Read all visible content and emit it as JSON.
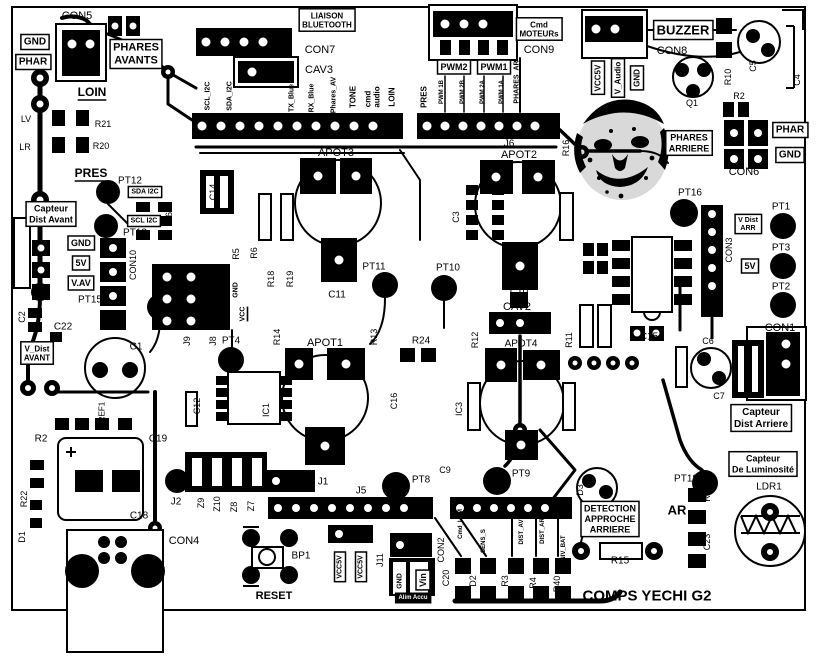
{
  "board": {
    "title": "COMPS YECHI G2",
    "colors": {
      "silkscreen": "#000000",
      "background": "#ffffff"
    }
  },
  "labels": [
    {
      "t": "CON5",
      "x": 77,
      "y": 16,
      "s": 11
    },
    {
      "t": "GND",
      "x": 35,
      "y": 42,
      "s": 10,
      "b": 1,
      "box": 1
    },
    {
      "t": "PHAR",
      "x": 33,
      "y": 62,
      "s": 10,
      "b": 1,
      "box": 1
    },
    {
      "t": "PHARES\nAVANTS",
      "x": 136,
      "y": 54,
      "s": 11,
      "b": 1,
      "box": 1,
      "n": "phares-avants-label"
    },
    {
      "t": "LOIN",
      "x": 92,
      "y": 92,
      "s": 12,
      "b": 1,
      "u": 1
    },
    {
      "t": "LV",
      "x": 26,
      "y": 119,
      "s": 9
    },
    {
      "t": "R21",
      "x": 103,
      "y": 124,
      "s": 9
    },
    {
      "t": "LR",
      "x": 25,
      "y": 147,
      "s": 9
    },
    {
      "t": "R20",
      "x": 101,
      "y": 146,
      "s": 9
    },
    {
      "t": "PRES",
      "x": 91,
      "y": 173,
      "s": 12,
      "b": 1,
      "u": 1
    },
    {
      "t": "LIAISON\nBLUETOOTH",
      "x": 327,
      "y": 20,
      "s": 8,
      "b": 1,
      "box": 1,
      "n": "liaison-bluetooth-label"
    },
    {
      "t": "CON7",
      "x": 320,
      "y": 50,
      "s": 11
    },
    {
      "t": "CAV3",
      "x": 319,
      "y": 70,
      "s": 11
    },
    {
      "t": "SCL_I2C",
      "x": 208,
      "y": 96,
      "s": 7,
      "b": 1,
      "r": -90
    },
    {
      "t": "SDA_I2C",
      "x": 230,
      "y": 96,
      "s": 7,
      "b": 1,
      "r": -90
    },
    {
      "t": "TX_Blue",
      "x": 292,
      "y": 98,
      "s": 7,
      "b": 1,
      "r": -90
    },
    {
      "t": "RX_Blue",
      "x": 312,
      "y": 98,
      "s": 7,
      "b": 1,
      "r": -90
    },
    {
      "t": "Phares_AV",
      "x": 334,
      "y": 95,
      "s": 7,
      "b": 1,
      "r": -90
    },
    {
      "t": "TONE",
      "x": 353,
      "y": 97,
      "s": 8,
      "b": 1,
      "r": -90
    },
    {
      "t": "cmd",
      "x": 368,
      "y": 99,
      "s": 8,
      "b": 1,
      "r": -90
    },
    {
      "t": "audio",
      "x": 377,
      "y": 97,
      "s": 8,
      "b": 1,
      "r": -90
    },
    {
      "t": "LOIN",
      "x": 392,
      "y": 97,
      "s": 8,
      "b": 1,
      "r": -90
    },
    {
      "t": "PRES",
      "x": 424,
      "y": 97,
      "s": 8,
      "b": 1,
      "r": -90
    },
    {
      "t": "PWM 1B",
      "x": 442,
      "y": 92,
      "s": 6,
      "b": 1,
      "r": -90
    },
    {
      "t": "PWM 2B",
      "x": 463,
      "y": 92,
      "s": 6,
      "b": 1,
      "r": -90
    },
    {
      "t": "PWM 2A",
      "x": 483,
      "y": 92,
      "s": 6,
      "b": 1,
      "r": -90
    },
    {
      "t": "PWM 1A",
      "x": 502,
      "y": 92,
      "s": 6,
      "b": 1,
      "r": -90
    },
    {
      "t": "PHARES_AR",
      "x": 517,
      "y": 82,
      "s": 7,
      "b": 1,
      "r": -90
    },
    {
      "t": "PWM2",
      "x": 454,
      "y": 67,
      "s": 9,
      "b": 1,
      "box": 1
    },
    {
      "t": "PWM1",
      "x": 494,
      "y": 67,
      "s": 9,
      "b": 1,
      "box": 1
    },
    {
      "t": "Cmd\nMOTEURs",
      "x": 539,
      "y": 29,
      "s": 8,
      "b": 1,
      "box": 1,
      "n": "cmd-moteurs-label"
    },
    {
      "t": "CON9",
      "x": 539,
      "y": 50,
      "s": 11
    },
    {
      "t": "BUZZER",
      "x": 683,
      "y": 30,
      "s": 13,
      "b": 1,
      "box": 1,
      "n": "buzzer-label"
    },
    {
      "t": "CON8",
      "x": 672,
      "y": 51,
      "s": 11
    },
    {
      "t": "VCC5V",
      "x": 598,
      "y": 78,
      "s": 8,
      "b": 1,
      "r": -90,
      "box": 1
    },
    {
      "t": "V_Audio",
      "x": 618,
      "y": 78,
      "s": 8,
      "b": 1,
      "r": -90,
      "box": 1
    },
    {
      "t": "GND",
      "x": 637,
      "y": 78,
      "s": 8,
      "b": 1,
      "r": -90,
      "box": 1
    },
    {
      "t": "Q1",
      "x": 692,
      "y": 103,
      "s": 9
    },
    {
      "t": "C5",
      "x": 753,
      "y": 66,
      "s": 9,
      "r": -90
    },
    {
      "t": "C4",
      "x": 797,
      "y": 80,
      "s": 9,
      "r": -90
    },
    {
      "t": "R10",
      "x": 728,
      "y": 77,
      "s": 9,
      "r": -90
    },
    {
      "t": "R2",
      "x": 739,
      "y": 96,
      "s": 9
    },
    {
      "t": "PHAR",
      "x": 790,
      "y": 130,
      "s": 10,
      "b": 1,
      "box": 1
    },
    {
      "t": "GND",
      "x": 790,
      "y": 155,
      "s": 10,
      "b": 1,
      "box": 1
    },
    {
      "t": "PHARES\nARRIERE",
      "x": 689,
      "y": 143,
      "s": 9,
      "b": 1,
      "box": 1,
      "n": "phares-arriere-label"
    },
    {
      "t": "CON6",
      "x": 744,
      "y": 172,
      "s": 11
    },
    {
      "t": "R16",
      "x": 566,
      "y": 148,
      "s": 9,
      "r": -90
    },
    {
      "t": "J6",
      "x": 509,
      "y": 144,
      "s": 10
    },
    {
      "t": "APOT2",
      "x": 519,
      "y": 155,
      "s": 11
    },
    {
      "t": "APOT3",
      "x": 336,
      "y": 153,
      "s": 11
    },
    {
      "t": "PT16",
      "x": 690,
      "y": 193,
      "s": 10
    },
    {
      "t": "PT1",
      "x": 781,
      "y": 207,
      "s": 10
    },
    {
      "t": "V Dist\nARR",
      "x": 748,
      "y": 224,
      "s": 7,
      "b": 1,
      "box": 1
    },
    {
      "t": "PT3",
      "x": 781,
      "y": 248,
      "s": 10
    },
    {
      "t": "5V",
      "x": 750,
      "y": 266,
      "s": 9,
      "b": 1,
      "box": 1
    },
    {
      "t": "PT2",
      "x": 781,
      "y": 287,
      "s": 10
    },
    {
      "t": "CON3",
      "x": 729,
      "y": 250,
      "s": 9,
      "r": -90
    },
    {
      "t": "CON1",
      "x": 780,
      "y": 328,
      "s": 11
    },
    {
      "t": "Capteur\nDist Avant",
      "x": 51,
      "y": 214,
      "s": 9,
      "b": 1,
      "box": 1,
      "n": "capteur-dist-avant-label"
    },
    {
      "t": "PT12",
      "x": 130,
      "y": 181,
      "s": 10
    },
    {
      "t": "SDA I2C",
      "x": 145,
      "y": 192,
      "s": 7,
      "b": 1,
      "box": 1
    },
    {
      "t": "SCL I2C",
      "x": 144,
      "y": 221,
      "s": 7,
      "b": 1,
      "box": 1
    },
    {
      "t": "PT13",
      "x": 135,
      "y": 233,
      "s": 10
    },
    {
      "t": "IC6",
      "x": 169,
      "y": 219,
      "s": 9,
      "r": -90
    },
    {
      "t": "C14",
      "x": 213,
      "y": 192,
      "s": 9,
      "r": -90
    },
    {
      "t": "GND",
      "x": 81,
      "y": 243,
      "s": 9,
      "b": 1,
      "box": 1
    },
    {
      "t": "5V",
      "x": 81,
      "y": 263,
      "s": 9,
      "b": 1,
      "box": 1
    },
    {
      "t": "V.AV",
      "x": 81,
      "y": 283,
      "s": 9,
      "b": 1,
      "box": 1
    },
    {
      "t": "CON10",
      "x": 133,
      "y": 265,
      "s": 9,
      "r": -90
    },
    {
      "t": "PT15",
      "x": 90,
      "y": 300,
      "s": 10
    },
    {
      "t": "R5",
      "x": 236,
      "y": 254,
      "s": 9,
      "r": -90
    },
    {
      "t": "R6",
      "x": 254,
      "y": 253,
      "s": 9,
      "r": -90
    },
    {
      "t": "GND",
      "x": 236,
      "y": 290,
      "s": 7,
      "b": 1,
      "r": -90
    },
    {
      "t": "VCC",
      "x": 243,
      "y": 314,
      "s": 7,
      "b": 1,
      "r": -90,
      "u": 1
    },
    {
      "t": "C2",
      "x": 22,
      "y": 317,
      "s": 9,
      "r": -90
    },
    {
      "t": "C22",
      "x": 63,
      "y": 327,
      "s": 10
    },
    {
      "t": "C1",
      "x": 136,
      "y": 347,
      "s": 10
    },
    {
      "t": "V_Dist\nAVANT",
      "x": 37,
      "y": 353,
      "s": 8,
      "b": 1,
      "box": 1
    },
    {
      "t": "R18",
      "x": 271,
      "y": 279,
      "s": 9,
      "r": -90
    },
    {
      "t": "R19",
      "x": 290,
      "y": 279,
      "s": 9,
      "r": -90
    },
    {
      "t": "PT11",
      "x": 374,
      "y": 267,
      "s": 10
    },
    {
      "t": "PT10",
      "x": 448,
      "y": 268,
      "s": 10
    },
    {
      "t": "C11",
      "x": 337,
      "y": 295,
      "s": 10
    },
    {
      "t": "C10",
      "x": 519,
      "y": 292,
      "s": 10
    },
    {
      "t": "CAV2",
      "x": 517,
      "y": 307,
      "s": 11
    },
    {
      "t": "C3",
      "x": 456,
      "y": 217,
      "s": 9,
      "r": -90
    },
    {
      "t": "R12",
      "x": 475,
      "y": 340,
      "s": 9,
      "r": -90
    },
    {
      "t": "R11",
      "x": 569,
      "y": 340,
      "s": 9,
      "r": -90
    },
    {
      "t": "R24",
      "x": 421,
      "y": 341,
      "s": 10
    },
    {
      "t": "J9",
      "x": 187,
      "y": 341,
      "s": 9,
      "r": -90
    },
    {
      "t": "J8",
      "x": 213,
      "y": 341,
      "s": 9,
      "r": -90
    },
    {
      "t": "PT4",
      "x": 231,
      "y": 341,
      "s": 10
    },
    {
      "t": "R14",
      "x": 277,
      "y": 337,
      "s": 9,
      "r": -90
    },
    {
      "t": "APOT1",
      "x": 325,
      "y": 343,
      "s": 11
    },
    {
      "t": "APOT4",
      "x": 521,
      "y": 344,
      "s": 10
    },
    {
      "t": "R13",
      "x": 374,
      "y": 337,
      "s": 9,
      "r": -90
    },
    {
      "t": "C16",
      "x": 394,
      "y": 401,
      "s": 9,
      "r": -90
    },
    {
      "t": "IC3",
      "x": 459,
      "y": 409,
      "s": 9,
      "r": -90
    },
    {
      "t": "IC1",
      "x": 266,
      "y": 410,
      "s": 9,
      "r": -90
    },
    {
      "t": "C12",
      "x": 197,
      "y": 406,
      "s": 9,
      "r": -90
    },
    {
      "t": "C19",
      "x": 158,
      "y": 439,
      "s": 10
    },
    {
      "t": "R2",
      "x": 41,
      "y": 439,
      "s": 10
    },
    {
      "t": "REF1",
      "x": 102,
      "y": 412,
      "s": 8,
      "r": -90
    },
    {
      "t": "R22",
      "x": 24,
      "y": 499,
      "s": 9,
      "r": -90
    },
    {
      "t": "D1",
      "x": 22,
      "y": 537,
      "s": 9,
      "r": -90
    },
    {
      "t": "C18",
      "x": 139,
      "y": 516,
      "s": 10
    },
    {
      "t": "CON4",
      "x": 184,
      "y": 541,
      "s": 11
    },
    {
      "t": "J2",
      "x": 176,
      "y": 502,
      "s": 10
    },
    {
      "t": "Z9",
      "x": 201,
      "y": 503,
      "s": 9,
      "r": -90
    },
    {
      "t": "Z10",
      "x": 217,
      "y": 504,
      "s": 9,
      "r": -90
    },
    {
      "t": "Z8",
      "x": 234,
      "y": 507,
      "s": 9,
      "r": -90
    },
    {
      "t": "Z7",
      "x": 251,
      "y": 506,
      "s": 9,
      "r": -90
    },
    {
      "t": "J1",
      "x": 323,
      "y": 482,
      "s": 10
    },
    {
      "t": "J5",
      "x": 361,
      "y": 491,
      "s": 10
    },
    {
      "t": "PT8",
      "x": 421,
      "y": 480,
      "s": 10
    },
    {
      "t": "C9",
      "x": 445,
      "y": 470,
      "s": 9
    },
    {
      "t": "PT9",
      "x": 521,
      "y": 474,
      "s": 10
    },
    {
      "t": "BP1",
      "x": 301,
      "y": 556,
      "s": 10
    },
    {
      "t": "RESET",
      "x": 274,
      "y": 596,
      "s": 11,
      "b": 1,
      "n": "reset-label"
    },
    {
      "t": "VCC5V",
      "x": 340,
      "y": 567,
      "s": 7,
      "b": 1,
      "r": -90,
      "box": 1
    },
    {
      "t": "VCC5V",
      "x": 361,
      "y": 567,
      "s": 7,
      "b": 1,
      "r": -90,
      "box": 1
    },
    {
      "t": "J11",
      "x": 380,
      "y": 560,
      "s": 9,
      "r": -90
    },
    {
      "t": "GND",
      "x": 400,
      "y": 581,
      "s": 7,
      "b": 1,
      "r": -90
    },
    {
      "t": "Vin",
      "x": 423,
      "y": 580,
      "s": 9,
      "b": 1,
      "r": -90,
      "box": 1
    },
    {
      "t": "Alim Accu",
      "x": 413,
      "y": 598,
      "s": 6,
      "b": 1,
      "inv": 1,
      "box": 1,
      "n": "alim-accu-label"
    },
    {
      "t": "CON2",
      "x": 441,
      "y": 550,
      "s": 9,
      "r": -90
    },
    {
      "t": "C20",
      "x": 446,
      "y": 578,
      "s": 9,
      "r": -90
    },
    {
      "t": "Cmd_LUM",
      "x": 461,
      "y": 524,
      "s": 6,
      "b": 1,
      "r": -90
    },
    {
      "t": "SENS_S",
      "x": 484,
      "y": 541,
      "s": 6,
      "b": 1,
      "r": -90
    },
    {
      "t": "DIST_AV",
      "x": 522,
      "y": 532,
      "s": 6,
      "b": 1,
      "r": -90
    },
    {
      "t": "DIST_AR",
      "x": 543,
      "y": 531,
      "s": 6,
      "b": 1,
      "r": -90
    },
    {
      "t": "NIV_BAT",
      "x": 564,
      "y": 548,
      "s": 6,
      "b": 1,
      "r": -90
    },
    {
      "t": "D2",
      "x": 473,
      "y": 581,
      "s": 9,
      "r": -90
    },
    {
      "t": "R3",
      "x": 505,
      "y": 581,
      "s": 9,
      "r": -90
    },
    {
      "t": "R4",
      "x": 533,
      "y": 583,
      "s": 9,
      "r": -90
    },
    {
      "t": "R40",
      "x": 557,
      "y": 584,
      "s": 9,
      "r": -90
    },
    {
      "t": "D3",
      "x": 580,
      "y": 490,
      "s": 9,
      "r": -90
    },
    {
      "t": "DETECTION\nAPPROCHE\nARRIERE",
      "x": 610,
      "y": 519,
      "s": 9,
      "b": 1,
      "box": 1,
      "n": "detection-approche-arriere-label"
    },
    {
      "t": "AR",
      "x": 677,
      "y": 510,
      "s": 13,
      "b": 1
    },
    {
      "t": "PT18",
      "x": 686,
      "y": 479,
      "s": 10
    },
    {
      "t": "R15",
      "x": 620,
      "y": 561,
      "s": 10
    },
    {
      "t": "Capteur\nDist Arriere",
      "x": 761,
      "y": 418,
      "s": 10,
      "b": 1,
      "box": 1,
      "n": "capteur-dist-arriere-label"
    },
    {
      "t": "Capteur\nDe Luminosité",
      "x": 763,
      "y": 464,
      "s": 9,
      "b": 1,
      "box": 1,
      "n": "capteur-luminosite-label"
    },
    {
      "t": "LDR1",
      "x": 769,
      "y": 487,
      "s": 10
    },
    {
      "t": "R7",
      "x": 707,
      "y": 496,
      "s": 9,
      "r": -90
    },
    {
      "t": "C23",
      "x": 707,
      "y": 542,
      "s": 9,
      "r": -90
    },
    {
      "t": "C6",
      "x": 708,
      "y": 341,
      "s": 9
    },
    {
      "t": "C7",
      "x": 719,
      "y": 396,
      "s": 9
    },
    {
      "t": "C15",
      "x": 649,
      "y": 337,
      "s": 10
    }
  ]
}
